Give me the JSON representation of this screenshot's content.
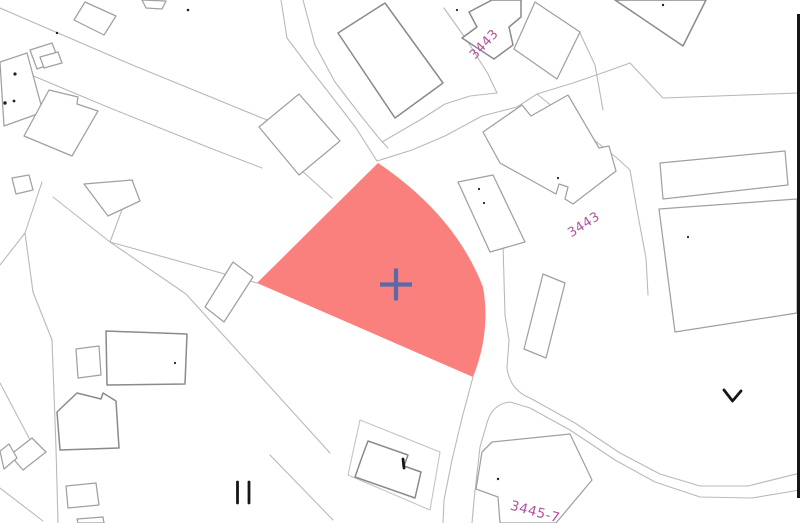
{
  "map": {
    "parcel_labels": [
      {
        "text": "3443"
      },
      {
        "text": "3443"
      },
      {
        "text": "3445-7"
      }
    ],
    "highlighted_parcel": {
      "marker": "cross",
      "fill": "#fa807e"
    },
    "colors": {
      "label_text": "#b2509f",
      "marker_cross": "#5b69a6",
      "road_line": "#b9b9b9",
      "building_line": "#a0a0a0",
      "building_line_dark": "#8a8a8a",
      "annotation_ink": "#161616",
      "speck_ink": "#222222",
      "background": "#ffffff"
    }
  }
}
